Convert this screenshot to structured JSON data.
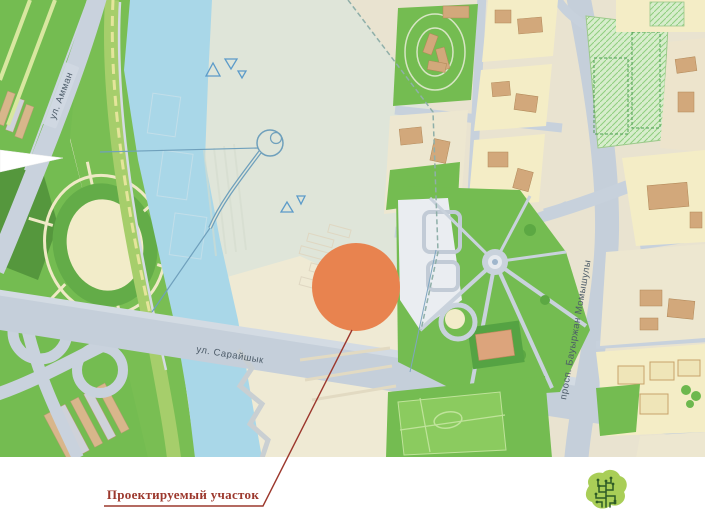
{
  "slide": {
    "annotation": {
      "text": "Проектируемый участок",
      "color": "#9c382d"
    },
    "marker": {
      "type": "site-circle",
      "color": "#e8834f"
    },
    "logo": {
      "icon": "tree-logo",
      "leaf_color": "#a9ce57",
      "branch_color": "#2e5b26"
    }
  },
  "map": {
    "street_labels": [
      {
        "id": "amman",
        "text": "ул. Амман"
      },
      {
        "id": "sarayshyk",
        "text": "ул. Сарайшык"
      },
      {
        "id": "momyshuly",
        "text": "просп. Бауыржан Момышулы"
      }
    ],
    "palette": {
      "water": "#a9d7e8",
      "park_green": "#74bc51",
      "road_gray": "#c5cfda",
      "building_tan": "#d2a87b",
      "block_yellow": "#f4edc6",
      "site_pale": "#dfe5d9",
      "site_cream": "#efead4",
      "street_label_text": "#4c5b68"
    }
  }
}
